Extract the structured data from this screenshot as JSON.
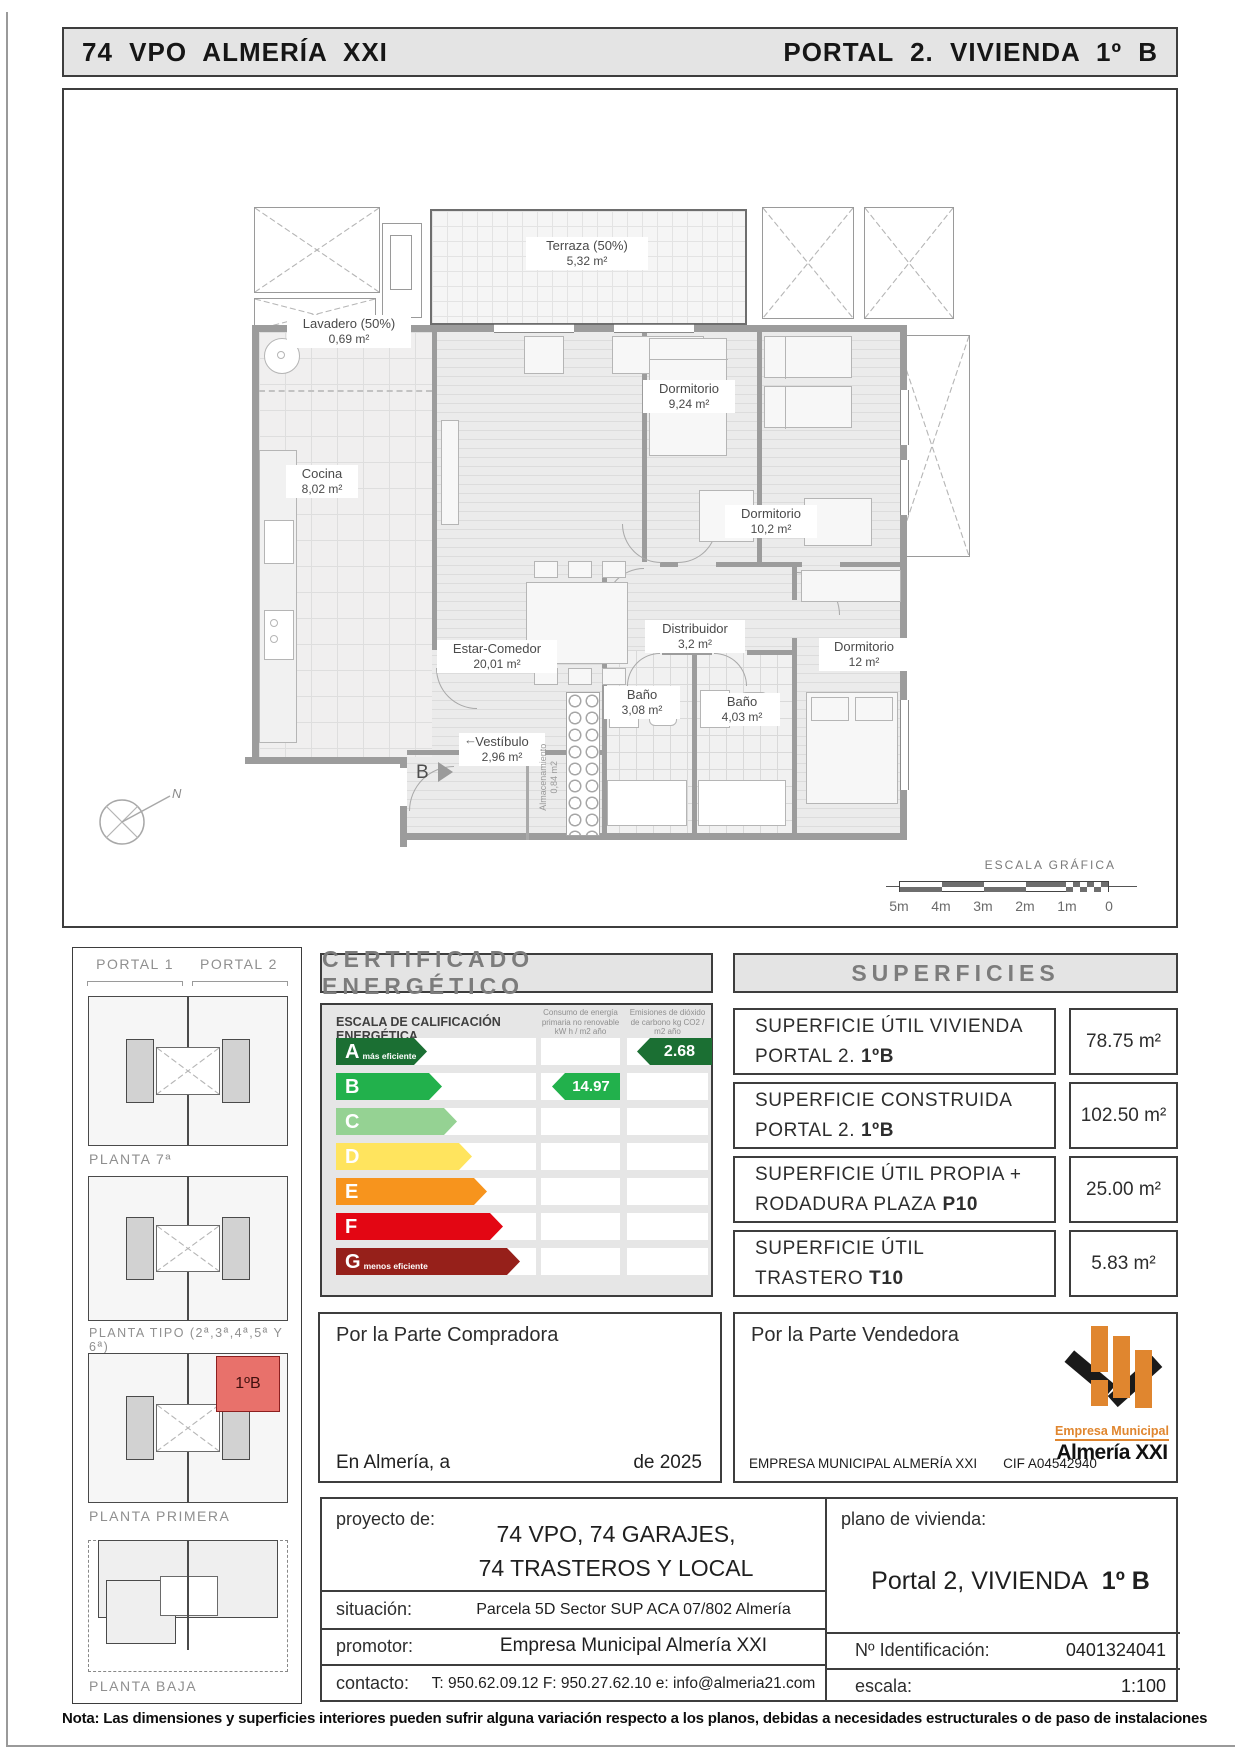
{
  "header": {
    "left": "74 VPO ALMERÍA XXI",
    "right": "PORTAL 2. VIVIENDA 1º B"
  },
  "plan": {
    "rooms": [
      {
        "name": "Terraza (50%)",
        "area": "5,32 m²"
      },
      {
        "name": "Lavadero (50%)",
        "area": "0,69 m²"
      },
      {
        "name": "Cocina",
        "area": "8,02 m²"
      },
      {
        "name": "Dormitorio",
        "area": "9,24 m²"
      },
      {
        "name": "Dormitorio",
        "area": "10,2 m²"
      },
      {
        "name": "Estar-Comedor",
        "area": "20,01 m²"
      },
      {
        "name": "Distribuidor",
        "area": "3,2 m²"
      },
      {
        "name": "Dormitorio",
        "area": "12 m²"
      },
      {
        "name": "Baño",
        "area": "3,08 m²"
      },
      {
        "name": "Baño",
        "area": "4,03 m²"
      },
      {
        "name": "Vestíbulo",
        "area": "2,96 m²"
      },
      {
        "name": "Almacenamiento",
        "area": "0,84 m2"
      }
    ],
    "entrance_label": "B",
    "compass_label": "N",
    "scale_bar": {
      "title": "ESCALA GRÁFICA",
      "ticks": [
        "5m",
        "4m",
        "3m",
        "2m",
        "1m",
        "0"
      ]
    }
  },
  "mini_plans": {
    "portal_left": "PORTAL 1",
    "portal_right": "PORTAL 2",
    "unit_highlight": "1ºB",
    "floors": [
      {
        "label": "PLANTA 7ª"
      },
      {
        "label": "PLANTA TIPO (2ª,3ª,4ª,5ª Y 6ª)"
      },
      {
        "label": "PLANTA PRIMERA"
      },
      {
        "label": "PLANTA BAJA"
      }
    ]
  },
  "energy": {
    "title": "CERTIFICADO ENERGÉTICO",
    "scale_header": "ESCALA DE CALIFICACIÓN ENERGÉTICA",
    "col1_header": "Consumo de energía primaria no renovable kW h / m2 año",
    "col2_header": "Emisiones de dióxido de carbono kg CO2 / m2 año",
    "ratings": [
      {
        "letter": "A",
        "suffix": "más eficiente",
        "color": "#1b6f33"
      },
      {
        "letter": "B",
        "suffix": "",
        "color": "#22b14c"
      },
      {
        "letter": "C",
        "suffix": "",
        "color": "#95d293"
      },
      {
        "letter": "D",
        "suffix": "",
        "color": "#ffe45e"
      },
      {
        "letter": "E",
        "suffix": "",
        "color": "#f7941d"
      },
      {
        "letter": "F",
        "suffix": "",
        "color": "#e30613"
      },
      {
        "letter": "G",
        "suffix": "menos eficiente",
        "color": "#96201a"
      }
    ],
    "consumption_value": "14.97",
    "consumption_rating": "B",
    "consumption_color": "#22b14c",
    "emissions_value": "2.68",
    "emissions_rating": "A",
    "emissions_color": "#1b6f33"
  },
  "superficies": {
    "title": "SUPERFICIES",
    "rows": [
      {
        "label_line1": "SUPERFICIE ÚTIL VIVIENDA",
        "label_line2": "PORTAL 2.",
        "label_bold": "1ºB",
        "value": "78.75 m²"
      },
      {
        "label_line1": "SUPERFICIE CONSTRUIDA",
        "label_line2": "PORTAL 2.",
        "label_bold": "1ºB",
        "value": "102.50 m²"
      },
      {
        "label_line1": "SUPERFICIE ÚTIL PROPIA +",
        "label_line2": "RODADURA PLAZA",
        "label_bold": "P10",
        "value": "25.00 m²"
      },
      {
        "label_line1": "SUPERFICIE ÚTIL",
        "label_line2": "TRASTERO",
        "label_bold": "T10",
        "value": "5.83 m²"
      }
    ]
  },
  "signatures": {
    "buyer_title": "Por la Parte Compradora",
    "buyer_place": "En Almería, a",
    "buyer_year": "de 2025",
    "seller_title": "Por la Parte Vendedora",
    "seller_company": "EMPRESA MUNICIPAL ALMERÍA XXI",
    "seller_cif": "CIF A04542940",
    "logo_line1": "Empresa Municipal",
    "logo_line2": "Almería XXI"
  },
  "project": {
    "proyecto_label": "proyecto de:",
    "proyecto_line1": "74 VPO, 74 GARAJES,",
    "proyecto_line2": "74 TRASTEROS Y LOCAL",
    "situacion_label": "situación:",
    "situacion_value": "Parcela 5D Sector SUP ACA 07/802 Almería",
    "promotor_label": "promotor:",
    "promotor_value": "Empresa Municipal Almería XXI",
    "contacto_label": "contacto:",
    "contacto_value": "T: 950.62.09.12   F: 950.27.62.10   e: info@almeria21.com",
    "plano_label": "plano de vivienda:",
    "plano_value": "Portal 2,  VIVIENDA",
    "plano_bold": "1º B",
    "id_label": "Nº Identificación:",
    "id_value": "0401324041",
    "escala_label": "escala:",
    "escala_value": "1:100"
  },
  "footer_note": "Nota: Las dimensiones y superficies interiores pueden sufrir alguna variación respecto a los planos, debidas a necesidades estructurales o de paso de instalaciones",
  "colors": {
    "unit_highlight": "#e8716b",
    "logo_orange": "#e0862f",
    "wall_grey": "#9c9c9c",
    "panel_grey": "#e4e4e4"
  }
}
